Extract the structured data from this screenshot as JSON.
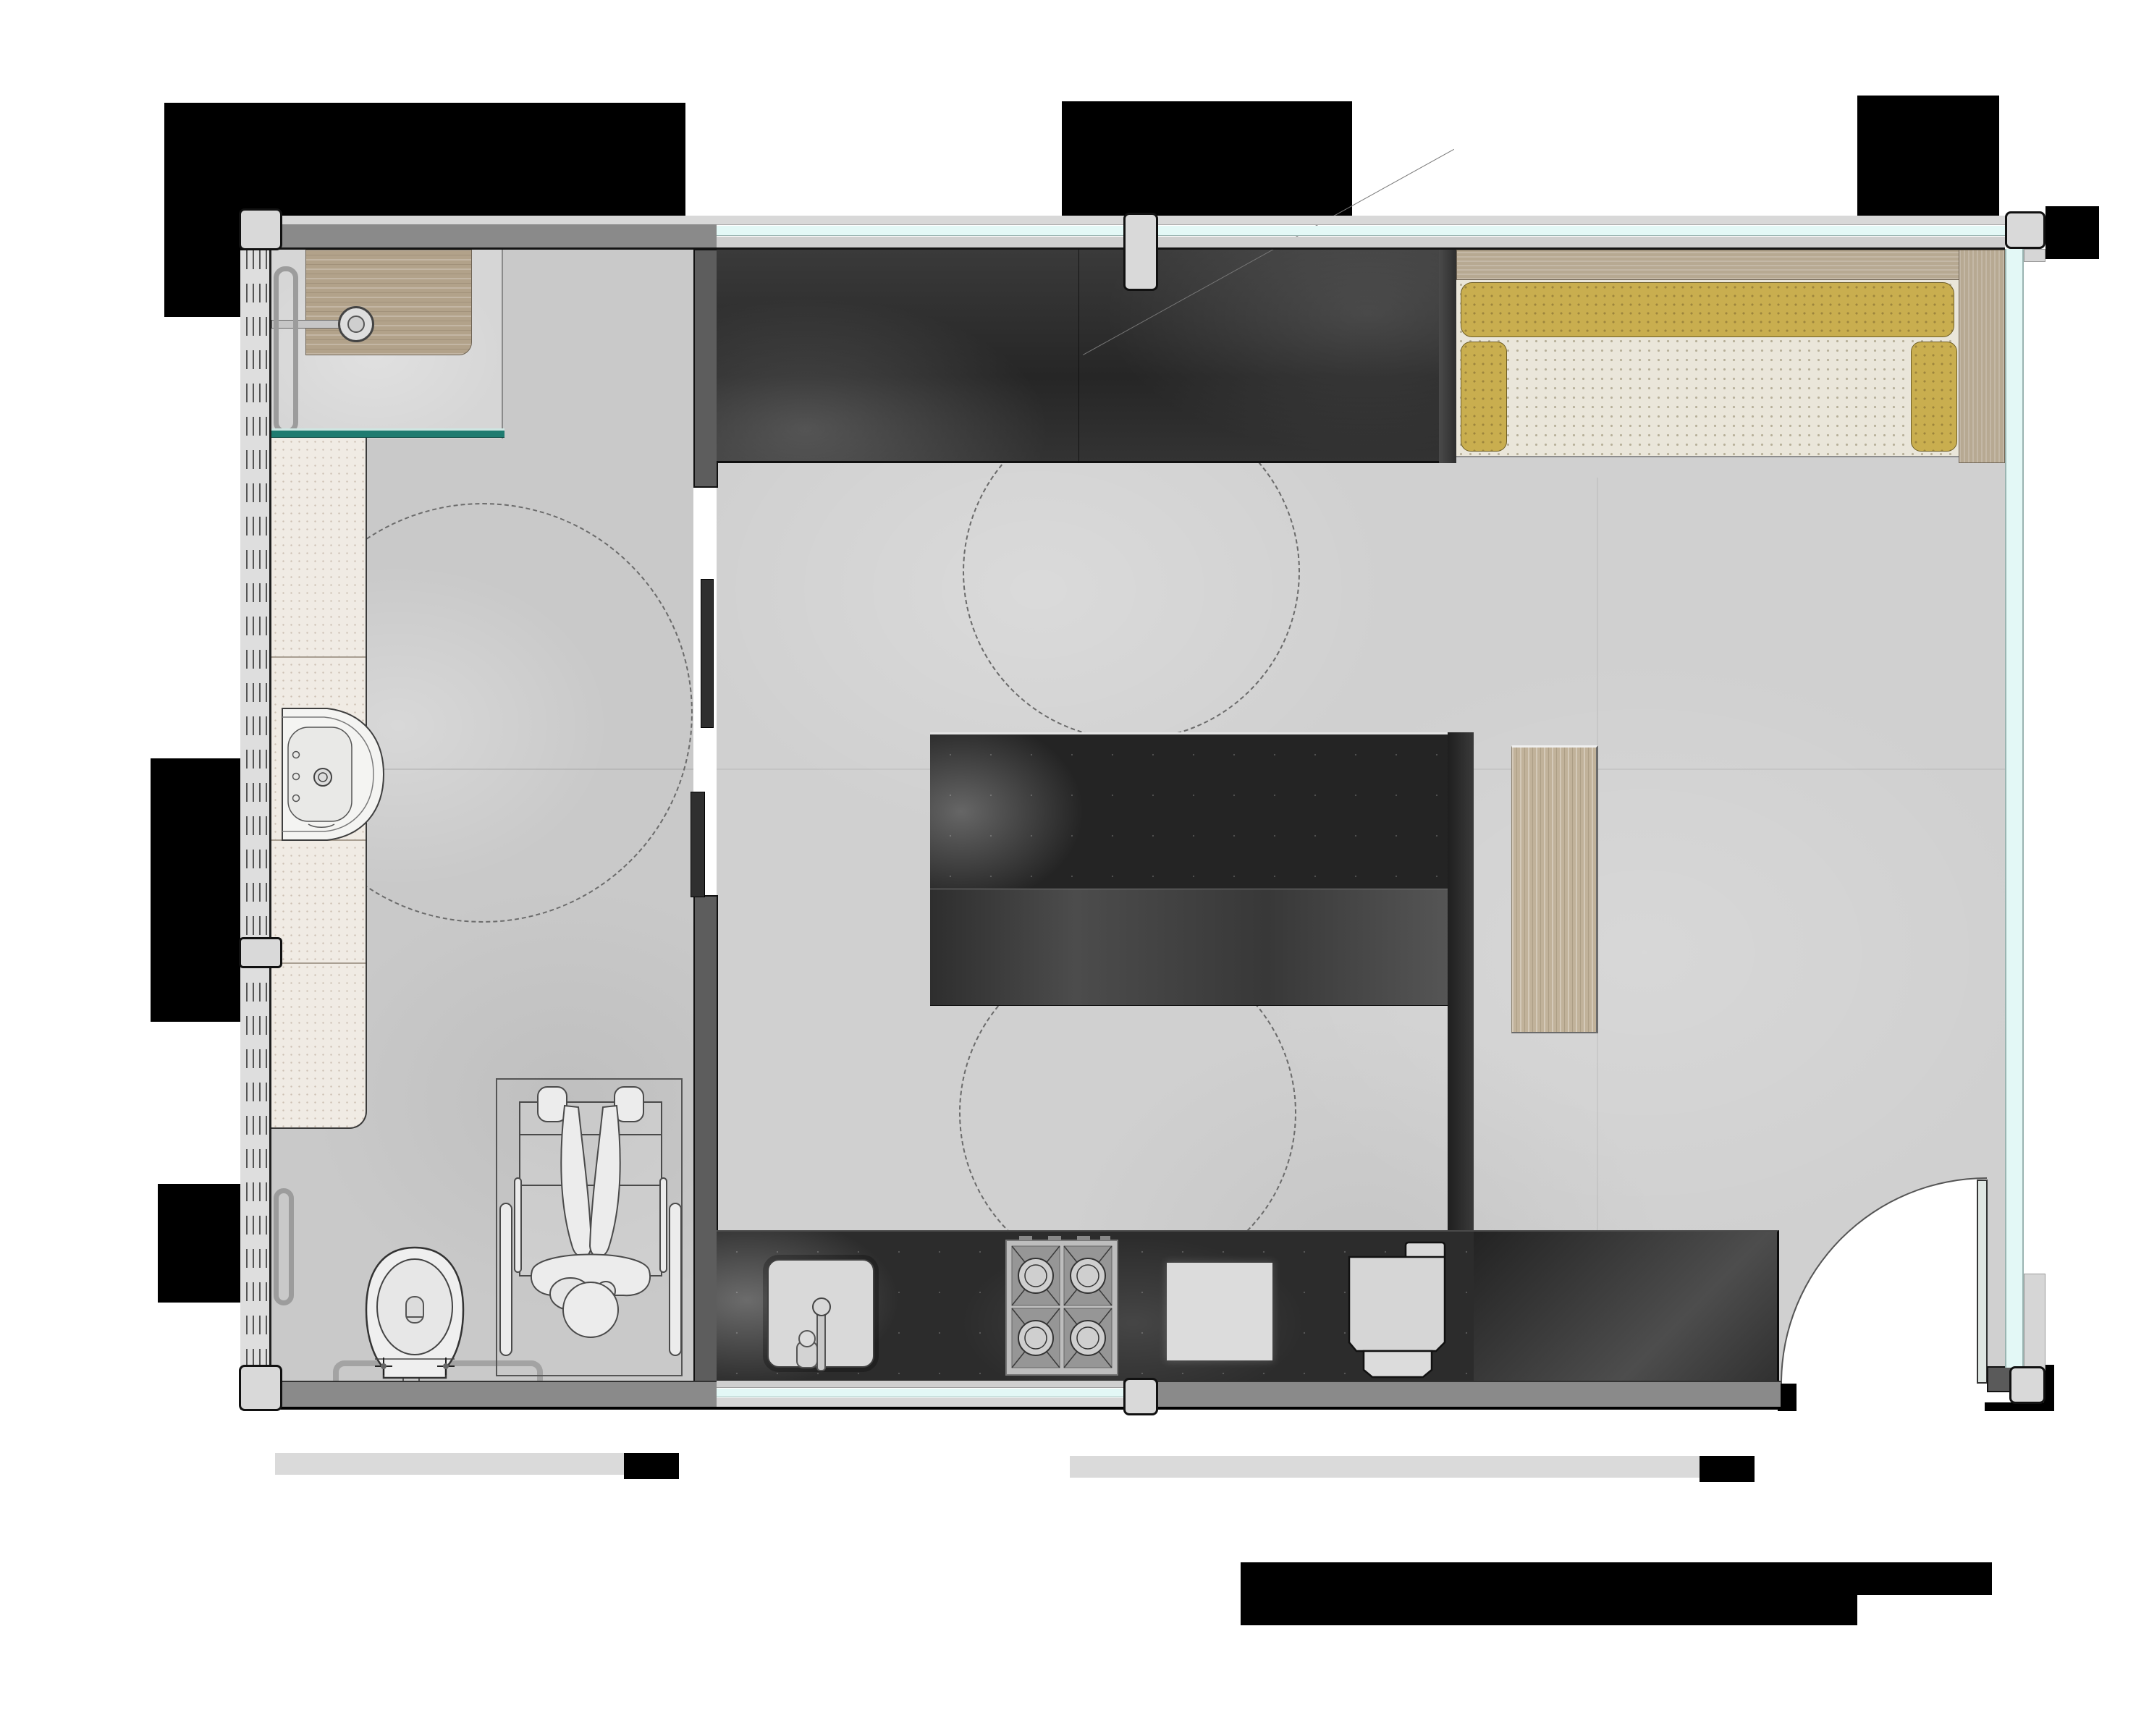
{
  "document": {
    "kind": "architectural floor plan",
    "description": "Top-view rendered plan of an accessible studio unit with bathroom and open living/kitchen space",
    "visible_text": []
  },
  "colors": {
    "shadow": "#000000",
    "siding": "#d8d8d8",
    "wall": "#8a8a8a",
    "wall_line": "#141414",
    "glass": "#e3f8f6",
    "glass_frame": "#9ab4b1",
    "teal": "#1f7b70",
    "floor_living": "#d0d0d0",
    "floor_bath": "#c9c9c9",
    "floor_shower": "#d6d6d6",
    "counter_tile": "#f0ebe4",
    "wood_bench": "#b2a28a",
    "wood_desk": "#c1b29a",
    "wood_frame": "#b7a992",
    "cushion_yellow": "#c9ae4f",
    "seat_fabric": "#eae6da",
    "dark_furniture": "#2b2b2b",
    "dark_counter": "#2c2c2c",
    "fixture_line": "#4a4a4a"
  },
  "rooms": [
    {
      "id": "bathroom",
      "features": [
        "shower-bench",
        "shower-head",
        "grab-bars",
        "glass-screen",
        "tiled-counter",
        "hand-basin",
        "toilet",
        "wheelchair-clear-space",
        "turning-circle"
      ]
    },
    {
      "id": "living-kitchen",
      "features": [
        "wardrobe",
        "sofa",
        "kitchen-island",
        "wood-desk-panel",
        "kitchen-counter",
        "kitchen-sink",
        "cooktop",
        "chopping-board",
        "dishwasher",
        "tall-cabinet",
        "entry-door",
        "turning-circles"
      ]
    }
  ],
  "openings": {
    "windows": [
      "top-glazed-band",
      "bottom-kitchen-window",
      "right-glass-wall",
      "left-slatted-wall"
    ],
    "doors": [
      "sliding-door-bathroom",
      "entry-swing-door"
    ]
  },
  "clearance_circles": {
    "count": 3,
    "style": "dashed"
  }
}
